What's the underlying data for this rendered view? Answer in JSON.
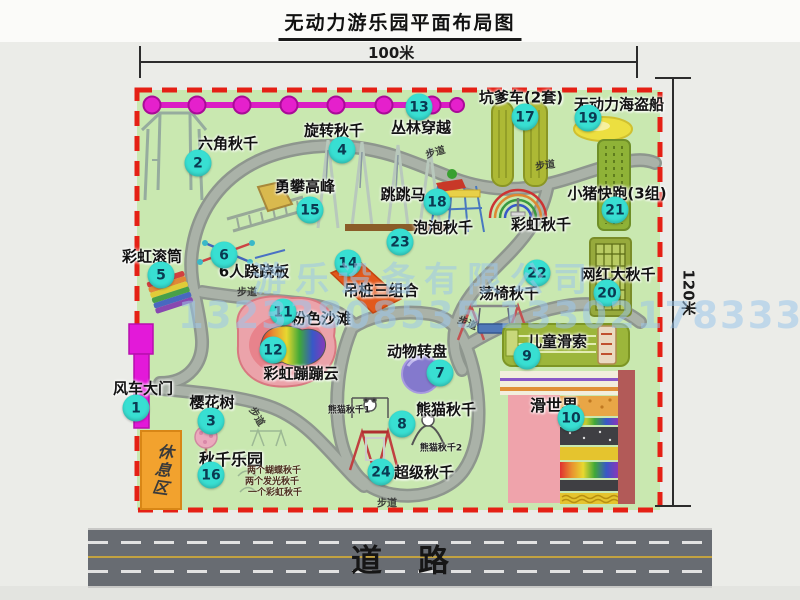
{
  "title": "无动力游乐园平面布局图",
  "dimensions": {
    "width_label": "100米",
    "height_label": "120米"
  },
  "road": {
    "label": "道路"
  },
  "path_label": "步道",
  "rest_area_label": "休息区",
  "rainbow_swing_label": "彩虹秋千",
  "watermark": {
    "line1": "游乐设备有限公司",
    "line2": "13233808535 13302178333"
  },
  "colors": {
    "park_green": "#c9e8b0",
    "border_red": "#e52015",
    "badge_cyan": "#38dfd2",
    "gate_magenta": "#e319d9",
    "chain_magenta": "#e520cc",
    "rest_orange": "#f2a22e",
    "road_gray": "#686c72"
  },
  "items": [
    {
      "num": "1",
      "label": "风车大门"
    },
    {
      "num": "2",
      "label": "六角秋千"
    },
    {
      "num": "3",
      "label": "樱花树"
    },
    {
      "num": "4",
      "label": "旋转秋千"
    },
    {
      "num": "5",
      "label": "彩虹滚筒"
    },
    {
      "num": "6",
      "label": "6人跷跷板"
    },
    {
      "num": "7",
      "label": "动物转盘"
    },
    {
      "num": "8",
      "label": "熊猫秋千"
    },
    {
      "num": "9",
      "label": "儿童滑索"
    },
    {
      "num": "10",
      "label": "滑世界"
    },
    {
      "num": "11",
      "label": "粉色沙滩"
    },
    {
      "num": "12",
      "label": "彩虹蹦蹦云"
    },
    {
      "num": "13",
      "label": "丛林穿越"
    },
    {
      "num": "14",
      "label": "吊桩三组合"
    },
    {
      "num": "15",
      "label": "勇攀高峰"
    },
    {
      "num": "16",
      "label": "秋千乐园"
    },
    {
      "num": "17",
      "label": "坑爹车(2套)"
    },
    {
      "num": "18",
      "label": "跳跳马"
    },
    {
      "num": "19",
      "label": "无动力海盗船"
    },
    {
      "num": "20",
      "label": "网红大秋千"
    },
    {
      "num": "21",
      "label": "小猪快跑(3组)"
    },
    {
      "num": "22",
      "label": "荡椅秋千"
    },
    {
      "num": "23",
      "label": "泡泡秋千"
    },
    {
      "num": "24",
      "label": "超级秋千"
    }
  ],
  "swing_park_notes": [
    "两个蝴蝶秋千",
    "两个发光秋千",
    "一个彩虹秋千"
  ],
  "panda_notes": [
    "熊猫秋千1",
    "熊猫秋千2"
  ]
}
